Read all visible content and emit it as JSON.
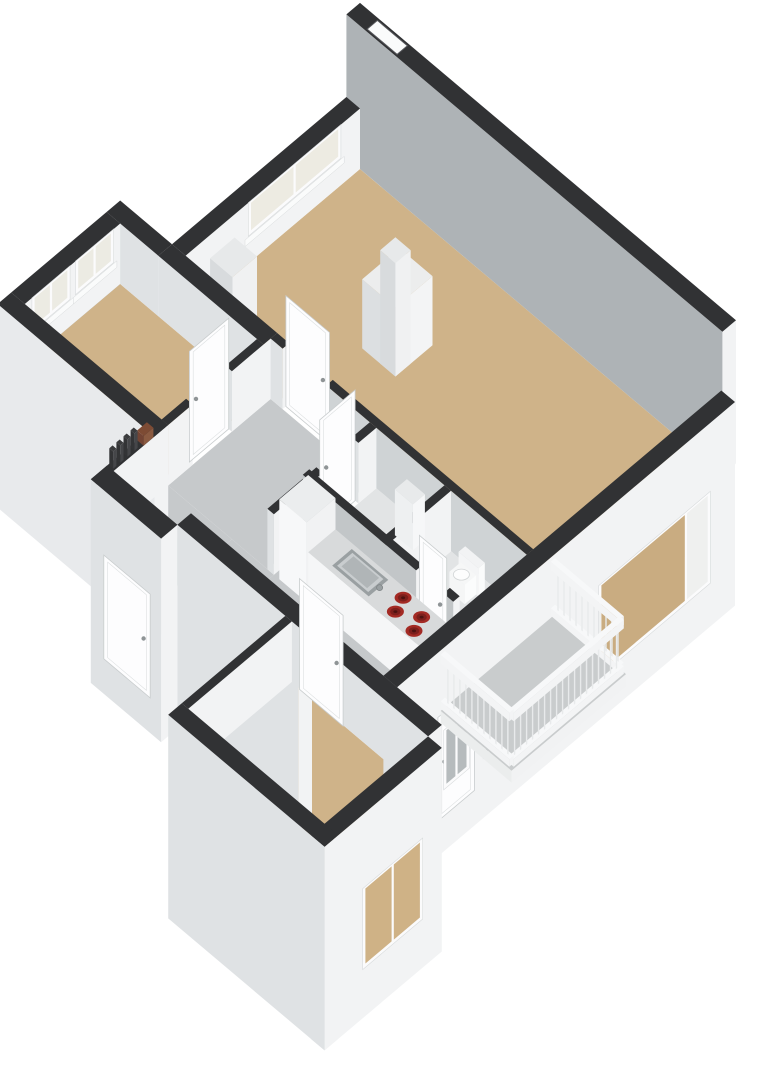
{
  "scene": {
    "width": 768,
    "height": 1086,
    "background": "#ffffff",
    "projection": {
      "A": 0.545,
      "B": 0.46,
      "C": 0.54,
      "OX": 360,
      "OY": 146
    },
    "palette": {
      "wallTop": "#313234",
      "faceU": "#f2f3f4",
      "faceV": "#dfe2e4",
      "floorWood": "#cfb389",
      "floorGray": "#c6c9cb",
      "floorBath": "#e2e4e5",
      "balconyFloor": "#c9cccd",
      "frame": "#fbfbfc",
      "frameEdge": "#d8dbdc",
      "doorLeaf": "#fdfdfe",
      "doorEdge": "#c9cdce",
      "handle": "#8f9496",
      "sill": "#fafbfb",
      "railBar": "#e8eaeb",
      "railRail": "#f3f4f5",
      "burnerOuter": "#a32a24",
      "burnerMid": "#7c1f1c",
      "burnerCore": "#4e1210",
      "sinkOuter": "#9aa0a2",
      "sinkRim": "#c9cdcf",
      "sinkBasin": "#b0b5b7"
    },
    "items": [
      {
        "t": "box",
        "name": "lower-storey-ledge",
        "r": [
          -140,
          345,
          -95,
          570
        ],
        "z": [
          -265,
          -10
        ],
        "top": "#37383a",
        "fu": "#a0a4a6",
        "fv": "#b4b7b9"
      },
      {
        "t": "floor",
        "name": "floor-living-room",
        "r": [
          25,
          25,
          663,
          345
        ],
        "f": "@floorWood"
      },
      {
        "t": "floor",
        "name": "floor-bedroom-1",
        "r": [
          -70,
          370,
          181,
          545
        ],
        "f": "@floorWood"
      },
      {
        "t": "floor",
        "name": "floor-hall-main",
        "r": [
          193,
          357,
          375,
          545
        ],
        "f": "@floorGray"
      },
      {
        "t": "floor",
        "name": "floor-hall-entry",
        "r": [
          193,
          545,
          310,
          650
        ],
        "f": "@floorGray"
      },
      {
        "t": "floor",
        "name": "floor-hall-link",
        "r": [
          310,
          545,
          387,
          620
        ],
        "f": "@floorGray"
      },
      {
        "t": "floor",
        "name": "floor-kitchen",
        "r": [
          387,
          492,
          663,
          620
        ],
        "f": "@floorGray"
      },
      {
        "t": "floor",
        "name": "floor-bathroom",
        "r": [
          387,
          357,
          512,
          480
        ],
        "f": "@floorBath"
      },
      {
        "t": "floor",
        "name": "floor-wc",
        "r": [
          524,
          357,
          663,
          480
        ],
        "f": "@floorBath"
      },
      {
        "t": "floor",
        "name": "floor-bedroom-2",
        "r": [
          520,
          645,
          770,
          835
        ],
        "f": "@floorWood"
      },
      {
        "t": "box",
        "name": "wall-northeast",
        "r": [
          0,
          0,
          690,
          25
        ],
        "z": [
          0,
          265
        ],
        "fv": "#aeb3b6"
      },
      {
        "t": "floor",
        "name": "wall-northeast-vent",
        "r": [
          35,
          3,
          90,
          22
        ],
        "z": 265,
        "f": "#fafbfb",
        "s": "#55565a"
      },
      {
        "t": "box",
        "name": "wall-northwest-living",
        "r": [
          0,
          25,
          25,
          345
        ],
        "z": [
          0,
          112
        ]
      },
      {
        "t": "win",
        "name": "window-living-northwest",
        "plane": "u",
        "at": 25,
        "a": [
          60,
          230
        ],
        "z": [
          50,
          112
        ],
        "glass": "#edebe2",
        "panes": 2,
        "sill": true
      },
      {
        "t": "box",
        "name": "chimney-breast",
        "r": [
          222,
          150,
          283,
          218
        ],
        "z": [
          0,
          128
        ],
        "top": "#eceded",
        "fu": "#f3f4f5",
        "fv": "#dcdfe1"
      },
      {
        "t": "box",
        "name": "chimney-column",
        "r": [
          255,
          190,
          283,
          218
        ],
        "z": [
          0,
          210
        ],
        "top": "#e7e9ea",
        "fu": "#f0f1f2",
        "fv": "#d8dbdd"
      },
      {
        "t": "box",
        "name": "wall-jog",
        "r": [
          -95,
          345,
          0,
          370
        ],
        "z": [
          0,
          112
        ]
      },
      {
        "t": "box",
        "name": "wall-bedroom1-northwest",
        "r": [
          -95,
          370,
          -70,
          545
        ],
        "z": [
          0,
          112
        ]
      },
      {
        "t": "win",
        "name": "window-bedroom1-a",
        "plane": "u",
        "at": -70,
        "a": [
          382,
          452
        ],
        "z": [
          50,
          112
        ],
        "glass": "#ecebe3",
        "panes": 2,
        "sill": true
      },
      {
        "t": "win",
        "name": "window-bedroom1-b",
        "plane": "u",
        "at": -70,
        "a": [
          462,
          532
        ],
        "z": [
          50,
          112
        ],
        "glass": "#ecebe3",
        "panes": 2,
        "sill": true
      },
      {
        "t": "box",
        "name": "column-bedroom1",
        "r": [
          140,
          370,
          181,
          415
        ],
        "z": [
          0,
          265
        ],
        "top": "#e7e9ea",
        "fu": "#f0f1f2",
        "fv": "#d8dbdd"
      },
      {
        "t": "box",
        "name": "wall-hall-north",
        "r": [
          0,
          345,
          193,
          370
        ],
        "z": [
          0,
          112
        ]
      },
      {
        "t": "box",
        "name": "wall-bedroom1-east-a",
        "r": [
          181,
          370,
          193,
          428
        ],
        "z": [
          0,
          112
        ]
      },
      {
        "t": "box",
        "name": "wall-bedroom1-east-b",
        "r": [
          181,
          500,
          193,
          545
        ],
        "z": [
          0,
          112
        ]
      },
      {
        "t": "door",
        "name": "door-bedroom-1",
        "plane": "u",
        "at": 187,
        "a": [
          428,
          500
        ],
        "z": [
          0,
          205
        ]
      },
      {
        "t": "box",
        "name": "wall-living-divider-a",
        "r": [
          193,
          345,
          215,
          357
        ],
        "z": [
          0,
          112
        ]
      },
      {
        "t": "box",
        "name": "wall-living-divider-b",
        "r": [
          295,
          345,
          663,
          357
        ],
        "z": [
          0,
          112
        ],
        "fv": "#cfd3d5"
      },
      {
        "t": "door",
        "name": "door-living-room",
        "plane": "v",
        "at": 351,
        "a": [
          215,
          295
        ],
        "z": [
          0,
          205
        ]
      },
      {
        "t": "box",
        "name": "wall-hall-east-a",
        "r": [
          375,
          357,
          387,
          390
        ],
        "z": [
          0,
          112
        ]
      },
      {
        "t": "box",
        "name": "wall-hall-east-b",
        "r": [
          375,
          455,
          387,
          545
        ],
        "z": [
          0,
          112
        ]
      },
      {
        "t": "door",
        "name": "door-bathroom",
        "plane": "u",
        "at": 381,
        "a": [
          390,
          455
        ],
        "z": [
          0,
          205
        ]
      },
      {
        "t": "box",
        "name": "wall-bath-wc-divider",
        "r": [
          512,
          357,
          524,
          480
        ],
        "z": [
          0,
          112
        ]
      },
      {
        "t": "box",
        "name": "bathroom-washbasin",
        "r": [
          455,
          369,
          488,
          391
        ],
        "z": [
          0,
          85
        ],
        "top": "#e8eaeb",
        "fu": "#f6f7f8",
        "fv": "#eef0f1"
      },
      {
        "t": "box",
        "name": "toilet-tank",
        "r": [
          562,
          369,
          598,
          381
        ],
        "z": [
          0,
          52
        ],
        "top": "#f2f3f4",
        "fu": "#fafbfb",
        "fv": "#f4f5f6"
      },
      {
        "t": "box",
        "name": "toilet-bowl",
        "r": [
          566,
          381,
          594,
          402
        ],
        "z": [
          0,
          36
        ],
        "top": "#f6f7f7",
        "fu": "#fbfcfc",
        "fv": "#f5f6f6"
      },
      {
        "t": "ell",
        "name": "toilet-seat",
        "u": 580,
        "v": 394,
        "zz": 36,
        "rx": 8,
        "ry": 5.5,
        "f": "#fdfdfd",
        "s": "#d2d5d6"
      },
      {
        "t": "box",
        "name": "wall-kitchen-north-a",
        "r": [
          387,
          480,
          595,
          492
        ],
        "z": [
          0,
          140
        ],
        "fv": "#c2c6c8"
      },
      {
        "t": "box",
        "name": "wall-kitchen-north-b",
        "r": [
          645,
          480,
          663,
          492
        ],
        "z": [
          0,
          140
        ],
        "fv": "#c2c6c8"
      },
      {
        "t": "door",
        "name": "door-wc",
        "plane": "v",
        "at": 486,
        "a": [
          595,
          645
        ],
        "z": [
          0,
          200
        ]
      },
      {
        "t": "box",
        "name": "kitchen-fridge",
        "r": [
          397,
          492,
          447,
          545
        ],
        "z": [
          0,
          148
        ],
        "top": "#ebedee",
        "fu": "#f1f2f3",
        "fv": "#f7f8f9"
      },
      {
        "t": "box",
        "name": "kitchen-counter",
        "r": [
          447,
          492,
          650,
          542
        ],
        "z": [
          0,
          90
        ],
        "top": "#d8dadb",
        "fu": "#eef0f1",
        "fv": "#f5f6f7"
      },
      {
        "t": "floor",
        "name": "kitchen-sink-outer",
        "r": [
          484,
          499,
          551,
          535
        ],
        "z": 91,
        "f": "@sinkOuter"
      },
      {
        "t": "floor",
        "name": "kitchen-sink-rim",
        "r": [
          489,
          503,
          546,
          531
        ],
        "z": 91.5,
        "f": "@sinkRim"
      },
      {
        "t": "floor",
        "name": "kitchen-sink-basin",
        "r": [
          494,
          506,
          541,
          528
        ],
        "z": 92,
        "f": "@sinkBasin"
      },
      {
        "t": "ell",
        "name": "kitchen-faucet",
        "u": 552,
        "v": 516,
        "zz": 92,
        "rx": 3,
        "ry": 3,
        "f": "#9aa0a2",
        "s": "#7f8486"
      },
      {
        "t": "burner",
        "name": "stove-burner-1",
        "u": 584,
        "v": 505
      },
      {
        "t": "burner",
        "name": "stove-burner-2",
        "u": 622,
        "v": 509
      },
      {
        "t": "burner",
        "name": "stove-burner-3",
        "u": 592,
        "v": 527
      },
      {
        "t": "burner",
        "name": "stove-burner-4",
        "u": 630,
        "v": 531
      },
      {
        "t": "box",
        "name": "wall-exterior-south-bed1",
        "r": [
          -95,
          545,
          193,
          570
        ],
        "z": [
          -265,
          112
        ],
        "fv": "#e8eaec"
      },
      {
        "t": "box",
        "name": "wall-entry-west",
        "r": [
          181,
          545,
          193,
          675
        ],
        "z": [
          0,
          112
        ]
      },
      {
        "t": "box",
        "name": "wall-entry-south",
        "r": [
          181,
          645,
          310,
          675
        ],
        "z": [
          -265,
          112
        ]
      },
      {
        "t": "door",
        "name": "door-entry",
        "plane": "v",
        "at": 675,
        "a": [
          205,
          290
        ],
        "z": [
          -200,
          -8
        ]
      },
      {
        "t": "box",
        "name": "entry-coat-rail",
        "r": [
          181,
          572,
          193,
          590
        ],
        "z": [
          112,
          130
        ],
        "top": "#7d4b34",
        "fu": "#8a5a41",
        "fv": "#734434"
      },
      {
        "t": "box",
        "name": "meter-bar-1",
        "r": [
          183,
          598,
          190,
          604
        ],
        "z": [
          112,
          144
        ],
        "top": "#3a3b3d",
        "fu": "#454649",
        "fv": "#333436"
      },
      {
        "t": "box",
        "name": "meter-bar-2",
        "r": [
          183,
          611,
          190,
          617
        ],
        "z": [
          112,
          144
        ],
        "top": "#3a3b3d",
        "fu": "#454649",
        "fv": "#333436"
      },
      {
        "t": "box",
        "name": "meter-bar-3",
        "r": [
          183,
          624,
          190,
          630
        ],
        "z": [
          112,
          144
        ],
        "top": "#3a3b3d",
        "fu": "#454649",
        "fv": "#333436"
      },
      {
        "t": "box",
        "name": "meter-bar-4",
        "r": [
          183,
          637,
          190,
          643
        ],
        "z": [
          112,
          144
        ],
        "top": "#3a3b3d",
        "fu": "#454649",
        "fv": "#333436"
      },
      {
        "t": "box",
        "name": "wall-exterior-step",
        "r": [
          310,
          620,
          532,
          645
        ],
        "z": [
          -265,
          112
        ]
      },
      {
        "t": "box",
        "name": "wall-facade-southeast",
        "r": [
          663,
          0,
          688,
          620
        ],
        "z": [
          -265,
          112
        ]
      },
      {
        "t": "win",
        "name": "window-living-southeast",
        "plane": "u",
        "at": 688,
        "a": [
          45,
          250
        ],
        "z": [
          -185,
          -15
        ],
        "glass": [
          "#eff0ef",
          "#c9ac81"
        ],
        "split": 90
      },
      {
        "t": "win",
        "name": "window-kitchen-southeast",
        "plane": "u",
        "at": 688,
        "a": [
          400,
          462
        ],
        "z": [
          -155,
          -25
        ],
        "glass": "#9aa0a3",
        "panes": 1
      },
      {
        "t": "door",
        "name": "door-balcony",
        "plane": "u",
        "at": 688,
        "a": [
          478,
          545
        ],
        "z": [
          -200,
          -8
        ]
      },
      {
        "t": "win",
        "name": "door-balcony-glass",
        "plane": "u",
        "at": 688.5,
        "a": [
          488,
          535
        ],
        "z": [
          -150,
          -40
        ],
        "glass": "#b6bbbd",
        "panes": 2
      },
      {
        "t": "box",
        "name": "balcony-slab",
        "r": [
          688,
          330,
          818,
          540
        ],
        "z": [
          -22,
          0
        ],
        "top": "@balconyFloor",
        "fu": "#f1f2f3",
        "fv": "#ebeded"
      },
      {
        "t": "rail",
        "name": "balcony-railing-north",
        "plane": "v",
        "at": 334,
        "a": [
          688,
          814
        ]
      },
      {
        "t": "rail",
        "name": "balcony-railing-east",
        "plane": "u",
        "at": 814,
        "a": [
          334,
          536
        ]
      },
      {
        "t": "rail",
        "name": "balcony-railing-south",
        "plane": "v",
        "at": 536,
        "a": [
          688,
          814
        ]
      },
      {
        "t": "box",
        "name": "wall-bedroom2-northwest",
        "r": [
          520,
          620,
          770,
          645
        ],
        "z": [
          0,
          112
        ]
      },
      {
        "t": "door",
        "name": "door-bedroom-2",
        "plane": "v",
        "at": 646,
        "a": [
          535,
          615
        ],
        "z": [
          0,
          205
        ]
      },
      {
        "t": "box",
        "name": "wall-bedroom2-west",
        "r": [
          508,
          645,
          520,
          835
        ],
        "z": [
          0,
          112
        ]
      },
      {
        "t": "box",
        "name": "wall-bedroom2-southeast",
        "r": [
          770,
          645,
          795,
          860
        ],
        "z": [
          -265,
          112
        ]
      },
      {
        "t": "win",
        "name": "window-bedroom2",
        "plane": "u",
        "at": 795,
        "a": [
          680,
          790
        ],
        "z": [
          -175,
          -25
        ],
        "glass": "#cfb286",
        "panes": 2
      },
      {
        "t": "box",
        "name": "wall-bedroom2-southwest",
        "r": [
          508,
          835,
          795,
          860
        ],
        "z": [
          -265,
          112
        ]
      }
    ]
  }
}
